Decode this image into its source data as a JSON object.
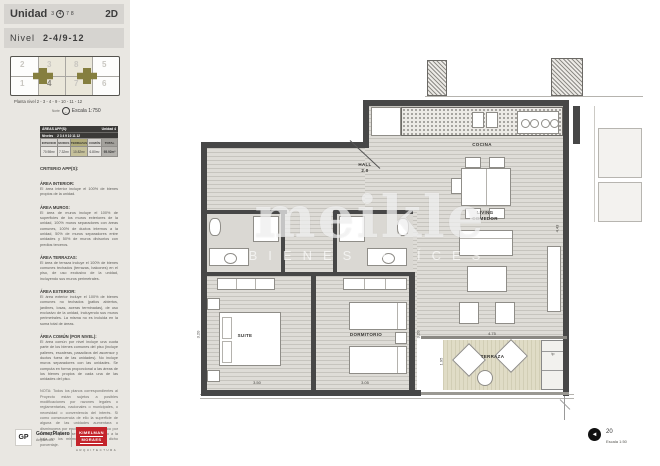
{
  "header": {
    "unidad_label": "Unidad",
    "units": [
      "3",
      "4",
      "7",
      "8"
    ],
    "unit_type": "2D",
    "nivel_label": "Nivel",
    "nivel_value": "2-4/9-12"
  },
  "keyplan": {
    "top_row": [
      "2",
      "3",
      "8",
      "5"
    ],
    "bottom_row": [
      "1",
      "4",
      "7",
      "6"
    ],
    "caption": "Planta nivel  2 - 3 - 4 - 9 - 10 - 11 - 12",
    "norte_label": "Norte",
    "escala": "Escala 1:750"
  },
  "areas_table": {
    "title": "ÁREAS APP(S):",
    "unit": "Unidad 4",
    "niveles_label": "Niveles",
    "niveles": "2 3 4 9 10 11 12",
    "columns": [
      "INTERIOR",
      "MUROS",
      "TERRAZAS",
      "COMÚN",
      "TOTAL"
    ],
    "values": [
      "70.98m²",
      "7.32m²",
      "10.82m²",
      "6.80m²",
      "95.92m²"
    ]
  },
  "criterio": {
    "title": "CRITERIO APP(S):",
    "blocks": [
      {
        "head": "ÁREA INTERIOR:",
        "body": "El área interior incluye el 100% de bienes propios de la unidad."
      },
      {
        "head": "ÁREA MUROS:",
        "body": "El área de muros incluye el 100% de superficies de los muros exteriores de la unidad, 100% muros separadores con áreas comunes, 100% de ductos internos a la unidad, 50% de muros separadores entre unidades y 50% de muros divisorios con predios terceros."
      },
      {
        "head": "ÁREA TERRAZAS:",
        "body": "El área de terraza incluye el 100% de bienes comunes techados (terrazas, balcones) en el piso, de uso exclusivo de la unidad, incluyendo sus muros perimetrales."
      },
      {
        "head": "ÁREA EXTERIOR:",
        "body": "El área exterior incluye el 100% de bienes comunes no techados (patios abiertos, jardines, losas, aceras terminadas), de uso exclusivo de la unidad, incluyendo sus muros perimetrales. La misma no es incluida en la suma total de áreas."
      },
      {
        "head": "ÁREA COMÚN (POR NIVEL):",
        "body": "El área común por nivel incluye una cuota parte de los bienes comunes del piso (incluye palieres, escaleras, pasadizos del ascensor y ductos fuera de las unidades). No incluye muros separadores con las unidades. Se computa en forma proporcional a las áreas de los bienes propios de cada una de las unidades del piso."
      },
      {
        "head": "",
        "body": "NOTA: Todos los planos correspondientes al Proyecto están sujetos a posibles modificaciones por razones legales o reglamentarias, nacionales o municipales, o necesidad o conveniencia del interés. Si como consecuencia de ello la superficie de alguna de las unidades aumentara o disminuyera por encima de un 5% (cinco por ciento), el precio se ajustará al alza o a la baja en los mismos términos por dicho porcentaje."
      }
    ]
  },
  "plan": {
    "labels": {
      "hall": "HALL",
      "hall_num": "2.0",
      "cocina": "COCINA",
      "living1": "LIVING",
      "living2": "COMEDOR",
      "suite": "SUITE",
      "dormitorio": "DORMITORIO",
      "terraza": "TERRAZA",
      "tp": "tp"
    },
    "dims": {
      "suite_w": "3.50",
      "dorm_w": "3.05",
      "terraza_w": "4.75",
      "terraza_d": "1.95",
      "living_d": "4.43",
      "suite_d": "3.20",
      "dorm_d": "3.20"
    }
  },
  "watermark": {
    "brand": "meikle",
    "tagline": "BIENES RAÍCES"
  },
  "footer": {
    "gp_initials": "GP",
    "gp_name": "GómezPlatero",
    "gp_sub": "Arquitectos",
    "km_line1": "KIMELMAN",
    "km_line2": "MORAES",
    "km_sub": "ARQUITECTURA",
    "sheet_no": "20",
    "escala": "Escala 1:50"
  }
}
